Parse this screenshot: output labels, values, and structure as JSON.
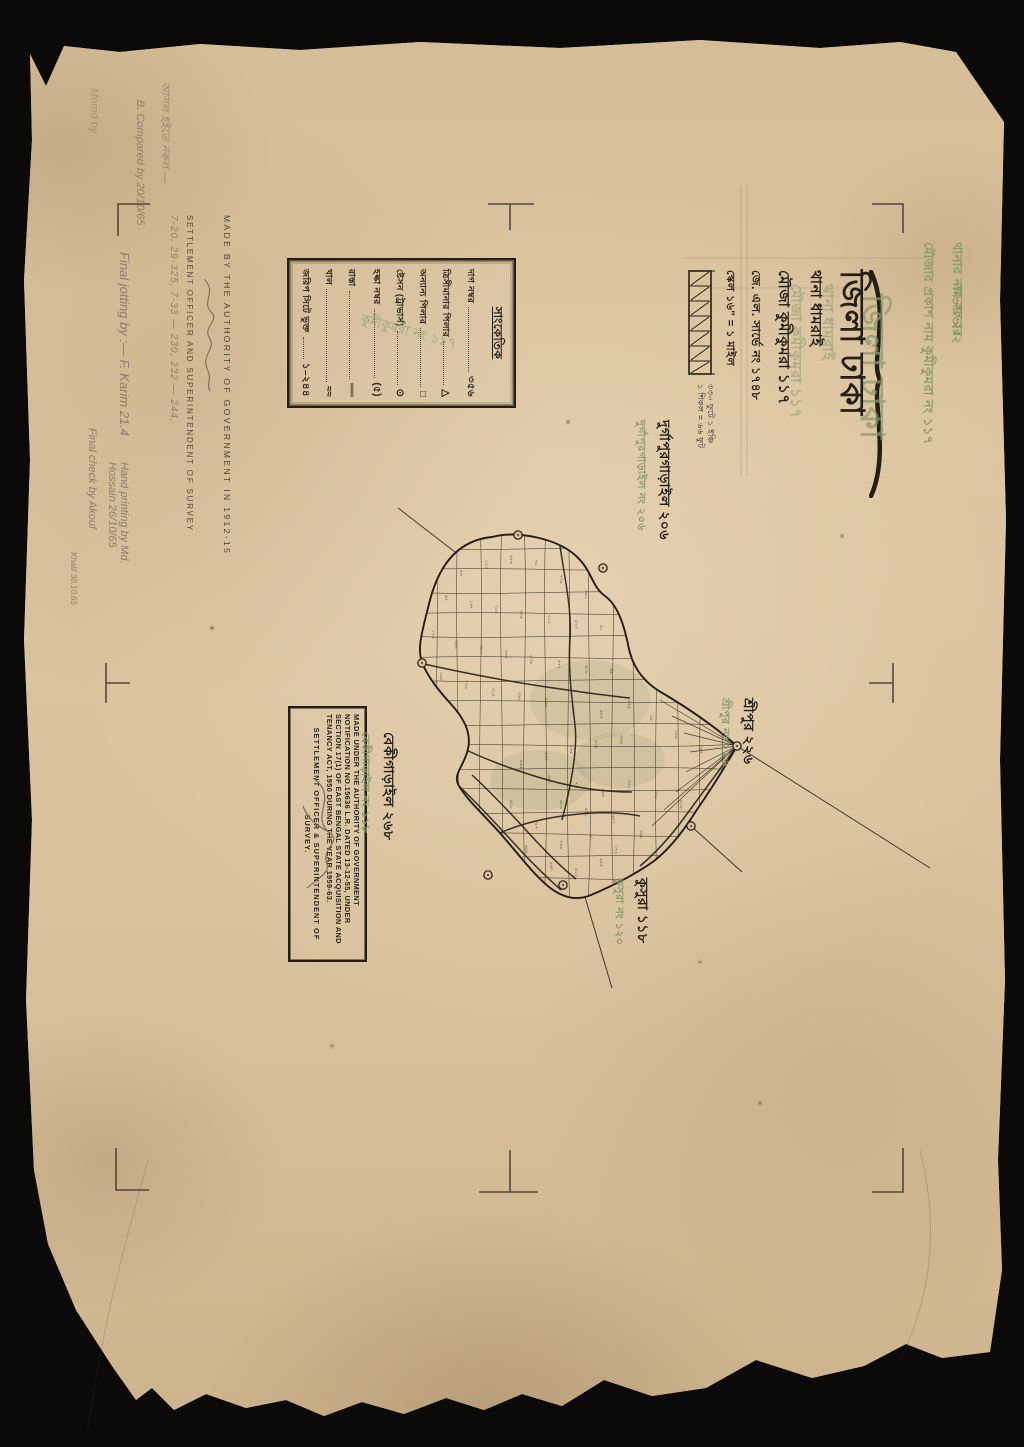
{
  "title_block": {
    "district_line": "জিলা ঢাকা",
    "thana_line": "থানা ধামরাই",
    "mouza_line": "মৌজা কুমীকুমরা ১১৭",
    "survey_line": "জে. এল. সার্ভে নং ১৭৪৮",
    "scale_line": "স্কেল ১৬″ = ১ মাইল",
    "scale_sub1": "৩৩০ ফুটে ১ ইঞ্চি",
    "scale_sub2": "১ শিকল = ৬৬ ফুট"
  },
  "green_stamp": {
    "line1": "থানার নাম সাভার",
    "line2": "মৌজার প্রকাশ নাম কুমীকুমরা নং ১১৭",
    "handwritten": "সাভার ২।২"
  },
  "legend": {
    "title": "সাংকেতিক",
    "watermark": "কুমীকুমরা নং ১১৭",
    "rows": [
      {
        "label": "দাগ নম্বর",
        "symbol": "৩৫৬"
      },
      {
        "label": "ত্রিসীমানার পিলার",
        "symbol": "△"
      },
      {
        "label": "অন্যান্য পিলার",
        "symbol": "□"
      },
      {
        "label": "ষ্টেসন (ট্রাভার্স)",
        "symbol": "⊙"
      },
      {
        "label": "হল্কা নম্বর",
        "symbol": "(৫)"
      },
      {
        "label": "রাস্তা",
        "symbol": "══"
      },
      {
        "label": "খাল",
        "symbol": "≈≈"
      },
      {
        "label": "জরিপ সিটে ভুক্ত",
        "symbol": "১–২৪৪"
      }
    ]
  },
  "authority_note": {
    "line1": "MADE BY THE AUTHORITY OF GOVERNMENT IN 1912-15",
    "line2": "SETTLEMENT OFFICER AND SUPERINTENDENT OF SURVEY",
    "pencil_numbers": "7-20, 29-325, 7-33 — 230, 232 — 244,"
  },
  "acquisition_stamp": {
    "body": "MADE UNDER THE AUTHORITY OF GOVERNMENT NOTIFICATION NO.15636 L.R. DATED 13-12-55, UNDER SECTION 17(1) OF EAST BENGAL STATE ACQUISITION AND TENANCY ACT, 1950 DURING THE YEAR 1959-63.",
    "footer": "SETTLEMENT OFFICER & SUPERINTENDENT OF SURVEY."
  },
  "adjacent_mouzas": [
    {
      "name_black": "দুর্গাপুরগাড়াইল ২০৬",
      "name_green": "দুর্গাপুরগাড়াইল নং ২০৬"
    },
    {
      "name_black": "শ্রীপুর ২২৬",
      "name_green": "শ্রীপুর নং ২২৬"
    },
    {
      "name_black": "কুসুরা ১১৮",
      "name_green": "কুসুরা নং ১২০"
    },
    {
      "name_black": "বেকীগাড়াইল ২৬৮",
      "name_green": "বেকীগাড়াইল নং ১১৮"
    }
  ],
  "annotations": {
    "bn_copy": "আসল হইতে নকল —",
    "compared": "B. Compared by 20/10/65",
    "memd": "Memd by",
    "final_jotting": "Final jotting by :— F. Karim 21.4",
    "hand_printing": "Hand printing by Md. Hossain 26/10/65",
    "final_check": "Final check by Akouf",
    "khalil": "Khalil 30.10.65",
    "green_script": "সাভার ২।২"
  },
  "map": {
    "plot_numbers": [
      {
        "n": "৫৬",
        "x": 460,
        "y": 570
      },
      {
        "n": "১২৩",
        "x": 485,
        "y": 560
      },
      {
        "n": "৪৫৬",
        "x": 510,
        "y": 555
      },
      {
        "n": "৭৮",
        "x": 535,
        "y": 560
      },
      {
        "n": "২০৫",
        "x": 560,
        "y": 575
      },
      {
        "n": "৩৪১",
        "x": 585,
        "y": 590
      },
      {
        "n": "৯২",
        "x": 445,
        "y": 595
      },
      {
        "n": "১৬৭",
        "x": 470,
        "y": 600
      },
      {
        "n": "২৮৮",
        "x": 495,
        "y": 605
      },
      {
        "n": "৩০৫",
        "x": 520,
        "y": 610
      },
      {
        "n": "৪১২",
        "x": 548,
        "y": 615
      },
      {
        "n": "৫২৩",
        "x": 575,
        "y": 620
      },
      {
        "n": "৬১",
        "x": 600,
        "y": 625
      },
      {
        "n": "১৭৫",
        "x": 432,
        "y": 630
      },
      {
        "n": "২৯৪",
        "x": 455,
        "y": 640
      },
      {
        "n": "৩৮০",
        "x": 480,
        "y": 645
      },
      {
        "n": "৪৪৭",
        "x": 505,
        "y": 650
      },
      {
        "n": "৫০৯",
        "x": 530,
        "y": 655
      },
      {
        "n": "৫৭২",
        "x": 558,
        "y": 660
      },
      {
        "n": "৬০৮",
        "x": 585,
        "y": 665
      },
      {
        "n": "৬৫",
        "x": 610,
        "y": 668
      },
      {
        "n": "১৪৮",
        "x": 440,
        "y": 672
      },
      {
        "n": "২২৬",
        "x": 465,
        "y": 680
      },
      {
        "n": "৩১৫",
        "x": 492,
        "y": 688
      },
      {
        "n": "৩৯৮",
        "x": 518,
        "y": 692
      },
      {
        "n": "৪৬৬",
        "x": 545,
        "y": 698
      },
      {
        "n": "৫৩০",
        "x": 572,
        "y": 705
      },
      {
        "n": "৫৮৭",
        "x": 600,
        "y": 710
      },
      {
        "n": "৬২৪",
        "x": 628,
        "y": 700
      },
      {
        "n": "৬৯",
        "x": 650,
        "y": 715
      },
      {
        "n": "১৫৯",
        "x": 675,
        "y": 730
      },
      {
        "n": "২৪৭",
        "x": 700,
        "y": 745
      },
      {
        "n": "৩৩৬",
        "x": 620,
        "y": 735
      },
      {
        "n": "৪০৮",
        "x": 595,
        "y": 740
      },
      {
        "n": "৪৭৫",
        "x": 570,
        "y": 745
      },
      {
        "n": "৫৪২",
        "x": 545,
        "y": 752
      },
      {
        "n": "৫৯৫",
        "x": 520,
        "y": 760
      },
      {
        "n": "৬৪০",
        "x": 548,
        "y": 775
      },
      {
        "n": "৭৩",
        "x": 575,
        "y": 782
      },
      {
        "n": "১৬৬",
        "x": 602,
        "y": 788
      },
      {
        "n": "২৫৮",
        "x": 628,
        "y": 780
      },
      {
        "n": "৩৪৮",
        "x": 655,
        "y": 790
      },
      {
        "n": "৪১৯",
        "x": 680,
        "y": 800
      },
      {
        "n": "৪৮৬",
        "x": 560,
        "y": 800
      },
      {
        "n": "৫৫১",
        "x": 585,
        "y": 808
      },
      {
        "n": "৬০২",
        "x": 612,
        "y": 815
      },
      {
        "n": "৬৪৮",
        "x": 640,
        "y": 830
      },
      {
        "n": "৮১",
        "x": 590,
        "y": 835
      },
      {
        "n": "১৭৪",
        "x": 615,
        "y": 845
      },
      {
        "n": "২৬৬",
        "x": 560,
        "y": 840
      },
      {
        "n": "৩৫৭",
        "x": 535,
        "y": 820
      },
      {
        "n": "৪২৮",
        "x": 510,
        "y": 800
      },
      {
        "n": "৪৯৪",
        "x": 525,
        "y": 845
      },
      {
        "n": "৫৬০",
        "x": 550,
        "y": 862
      },
      {
        "n": "৬১২",
        "x": 575,
        "y": 868
      },
      {
        "n": "৬৫৫",
        "x": 600,
        "y": 858
      }
    ],
    "geometry": {
      "boundary": "M492,537 C460,540 440,562 430,600 C422,632 416,650 423,665 C430,680 440,692 450,703 C462,716 472,731 468,749 C464,767 452,774 459,786 C468,801 484,815 500,833 C516,851 532,873 549,887 C563,898 577,901 591,895 C612,886 636,874 654,861 C672,847 686,827 698,808 C712,788 726,765 737,746 C713,725 683,705 659,691 C643,681 633,667 629,649 C625,629 619,606 605,596 C591,586 593,571 575,555 C557,539 518,530 492,537 Z",
      "roads": [
        "M560,546 C565,580 572,610 570,640 C568,670 572,700 575,725 C578,750 570,790 562,820",
        "M424,664 C460,672 500,680 540,686 C580,692 610,696 630,698",
        "M737,746 C718,772 700,796 684,818 C668,840 652,856 640,866",
        "M466,750 C492,762 520,772 548,780 C576,788 606,792 632,792",
        "M500,833 C520,824 545,818 570,815 C595,812 620,812 640,816",
        "M459,786 C480,806 502,830 522,852 C538,869 552,882 561,890",
        "M472,775 C494,795 516,819 536,841 C552,858 566,871 576,879"
      ],
      "grid_v": [
        "M436,520 C441,640 431,760 438,905",
        "M458,520 C453,640 463,760 456,905",
        "M480,520 C485,640 475,760 482,905",
        "M502,520 C497,640 507,760 500,905",
        "M524,520 C529,640 519,760 526,905",
        "M546,520 C541,640 551,760 544,905",
        "M568,520 C573,640 563,760 570,905",
        "M590,520 C585,640 595,760 588,905",
        "M612,520 C617,640 607,760 614,905",
        "M634,520 C629,640 639,760 632,905",
        "M656,520 C661,640 651,760 658,905",
        "M678,520 C673,640 683,760 676,905",
        "M700,520 C705,640 695,760 702,905",
        "M722,520 C717,640 727,760 720,905"
      ],
      "grid_h": [
        "M405,548 C510,553 615,543 740,550",
        "M405,570 C510,565 615,575 740,568",
        "M405,592 C510,597 615,587 740,594",
        "M405,614 C510,609 615,619 740,612",
        "M405,636 C510,641 615,631 740,638",
        "M405,658 C510,653 615,663 740,656",
        "M405,680 C510,685 615,675 740,682",
        "M405,702 C510,697 615,707 740,700",
        "M405,724 C510,729 615,719 740,726",
        "M405,746 C510,741 615,751 740,744",
        "M405,768 C510,773 615,763 740,770",
        "M405,790 C510,785 615,795 740,788",
        "M405,812 C510,817 615,807 740,814",
        "M405,834 C510,829 615,839 740,836",
        "M405,856 C510,861 615,851 740,858",
        "M405,878 C510,873 615,883 740,880"
      ],
      "fan": [
        "M737,746 L660,700",
        "M737,746 L672,716",
        "M737,746 L684,733",
        "M737,746 L690,752",
        "M737,746 L686,772",
        "M737,746 L676,792",
        "M737,746 L664,810",
        "M737,746 L652,826"
      ],
      "stations": [
        [
          518,
          535
        ],
        [
          603,
          568
        ],
        [
          422,
          663
        ],
        [
          737,
          746
        ],
        [
          691,
          826
        ],
        [
          563,
          885
        ],
        [
          488,
          875
        ]
      ],
      "rays": [
        [
          455,
          552,
          398,
          508
        ],
        [
          737,
          746,
          930,
          868
        ],
        [
          585,
          897,
          612,
          988
        ],
        [
          691,
          826,
          742,
          872
        ]
      ],
      "tints": [
        [
          590,
          700,
          60,
          40
        ],
        [
          540,
          780,
          50,
          30
        ],
        [
          620,
          760,
          45,
          28
        ]
      ]
    }
  },
  "colors": {
    "paper": "#d8c09b",
    "ink": "#241e16",
    "green_stamp": "#8c9a6d",
    "pencil": "#8d7e6b",
    "background": "#0b0a08"
  }
}
